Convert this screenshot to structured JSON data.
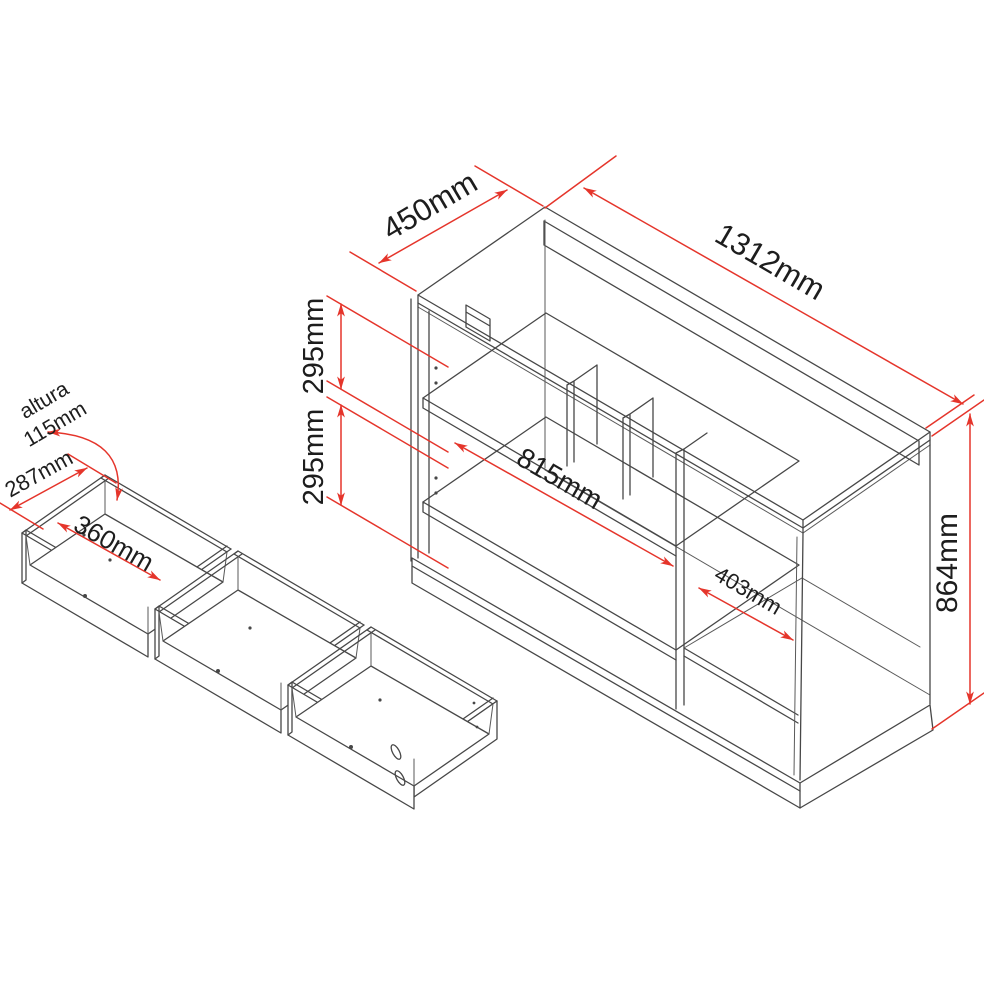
{
  "diagram": {
    "type": "furniture-dimension-drawing",
    "unit": "mm",
    "colors": {
      "dimension_red": "#e5352b",
      "line_gray": "#474747",
      "text": "#1d1d1d"
    },
    "cabinet": {
      "depth_label": "450mm",
      "width_label": "1312mm",
      "height_label": "864mm",
      "upper_shelf_label": "295mm",
      "lower_shelf_label": "295mm",
      "inner_width_label": "815mm",
      "right_compartment_label": "403mm"
    },
    "drawers": {
      "count": 3,
      "height_word": "altura",
      "height_label": "115mm",
      "depth_label": "287mm",
      "inner_width_label": "360mm"
    }
  }
}
